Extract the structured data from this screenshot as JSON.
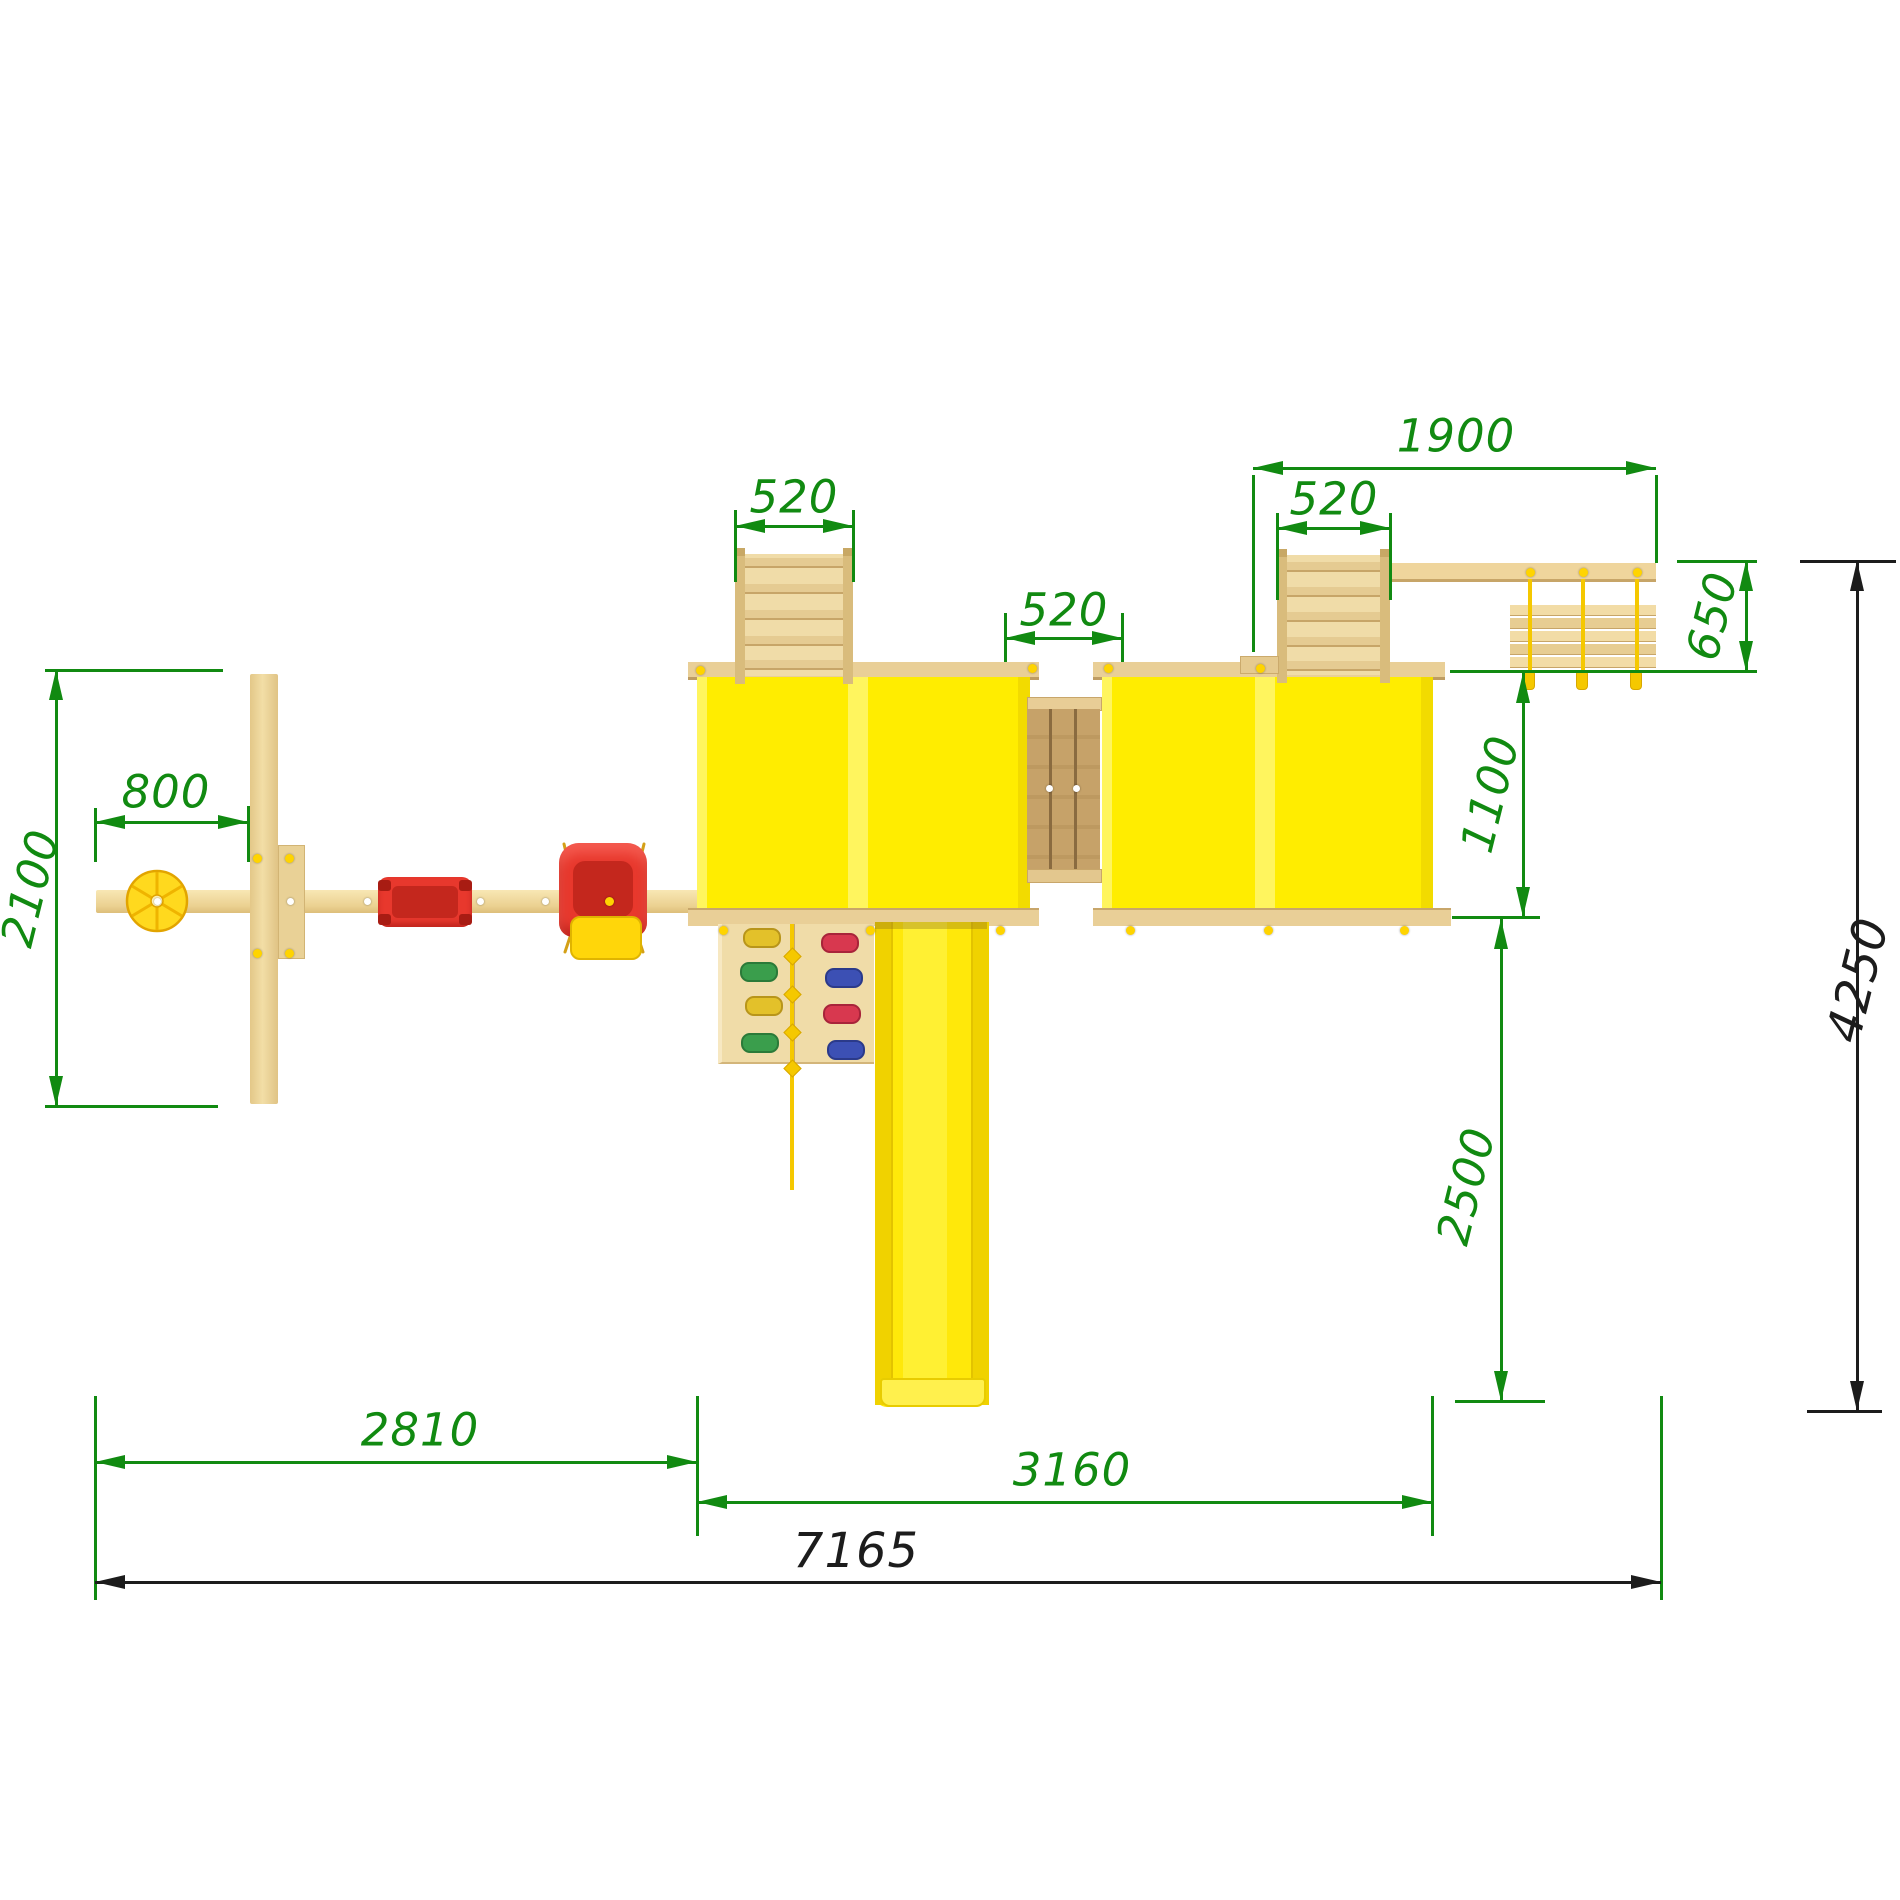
{
  "title": "Playground set – top view installation drawing",
  "units": "mm",
  "colors": {
    "dimension_green": "#118A11",
    "dimension_black": "#1c1c1c",
    "tower_yellow": "#FFED00",
    "slide_yellow": "#FFE80A",
    "wood_light": "#F2E0AB",
    "wood_floor": "#C4A067",
    "swing_red": "#E8382D",
    "rope_gold": "#F5C800"
  },
  "dimensions": [
    {
      "id": "dim-2100",
      "label": "2100",
      "c": "g",
      "fs": 45,
      "lx": 30,
      "ly": 888,
      "rot": -76,
      "lines": [
        [
          45,
          670,
          223,
          670
        ],
        [
          45,
          1106,
          218,
          1106
        ],
        [
          56,
          670,
          56,
          1106
        ]
      ],
      "arrows": [
        [
          56,
          670,
          "up"
        ],
        [
          56,
          1106,
          "down"
        ]
      ]
    },
    {
      "id": "dim-800",
      "label": "800",
      "c": "g",
      "fs": 45,
      "lx": 166,
      "ly": 792,
      "rot": 0,
      "lines": [
        [
          95,
          808,
          95,
          862
        ],
        [
          248,
          806,
          248,
          862
        ],
        [
          95,
          822,
          248,
          822
        ]
      ],
      "arrows": [
        [
          95,
          822,
          "left"
        ],
        [
          248,
          822,
          "right"
        ]
      ]
    },
    {
      "id": "dim-520-left",
      "label": "520",
      "c": "g",
      "fs": 45,
      "lx": 794,
      "ly": 497,
      "rot": 0,
      "lines": [
        [
          735,
          510,
          735,
          582
        ],
        [
          853,
          510,
          853,
          582
        ],
        [
          735,
          526,
          853,
          526
        ]
      ],
      "arrows": [
        [
          735,
          526,
          "left"
        ],
        [
          853,
          526,
          "right"
        ]
      ]
    },
    {
      "id": "dim-520-mid",
      "label": "520",
      "c": "g",
      "fs": 45,
      "lx": 1064,
      "ly": 610,
      "rot": 0,
      "lines": [
        [
          1005,
          613,
          1005,
          662
        ],
        [
          1122,
          613,
          1122,
          662
        ],
        [
          1005,
          638,
          1122,
          638
        ]
      ],
      "arrows": [
        [
          1005,
          638,
          "left"
        ],
        [
          1122,
          638,
          "right"
        ]
      ]
    },
    {
      "id": "dim-520-right",
      "label": "520",
      "c": "g",
      "fs": 45,
      "lx": 1334,
      "ly": 499,
      "rot": 0,
      "lines": [
        [
          1277,
          513,
          1277,
          600
        ],
        [
          1390,
          513,
          1390,
          600
        ],
        [
          1277,
          528,
          1390,
          528
        ]
      ],
      "arrows": [
        [
          1277,
          528,
          "left"
        ],
        [
          1390,
          528,
          "right"
        ]
      ]
    },
    {
      "id": "dim-1900",
      "label": "1900",
      "c": "g",
      "fs": 45,
      "lx": 1456,
      "ly": 436,
      "rot": 0,
      "lines": [
        [
          1253,
          475,
          1253,
          652
        ],
        [
          1656,
          475,
          1656,
          563
        ],
        [
          1253,
          468,
          1656,
          468
        ]
      ],
      "arrows": [
        [
          1253,
          468,
          "left"
        ],
        [
          1656,
          468,
          "right"
        ]
      ]
    },
    {
      "id": "dim-650",
      "label": "650",
      "c": "g",
      "fs": 45,
      "lx": 1712,
      "ly": 616,
      "rot": -76,
      "lines": [
        [
          1677,
          561,
          1757,
          561
        ],
        [
          1450,
          671,
          1757,
          671
        ],
        [
          1746,
          561,
          1746,
          671
        ]
      ],
      "arrows": [
        [
          1746,
          561,
          "up"
        ],
        [
          1746,
          671,
          "down"
        ]
      ]
    },
    {
      "id": "dim-1100",
      "label": "1100",
      "c": "g",
      "fs": 45,
      "lx": 1490,
      "ly": 794,
      "rot": -76,
      "lines": [
        [
          1523,
          671,
          1523,
          917
        ],
        [
          1452,
          917,
          1540,
          917
        ]
      ],
      "arrows": [
        [
          1523,
          673,
          "up"
        ],
        [
          1523,
          917,
          "down"
        ]
      ]
    },
    {
      "id": "dim-2500",
      "label": "2500",
      "c": "g",
      "fs": 45,
      "lx": 1466,
      "ly": 1186,
      "rot": -76,
      "lines": [
        [
          1501,
          917,
          1501,
          1401
        ],
        [
          1455,
          1401,
          1545,
          1401
        ]
      ],
      "arrows": [
        [
          1501,
          919,
          "up"
        ],
        [
          1501,
          1401,
          "down"
        ]
      ]
    },
    {
      "id": "dim-4250",
      "label": "4250",
      "c": "k",
      "fs": 48,
      "lx": 1858,
      "ly": 980,
      "rot": -76,
      "lines": [
        [
          1800,
          561,
          1896,
          561
        ],
        [
          1807,
          1411,
          1882,
          1411
        ],
        [
          1857,
          561,
          1857,
          1411
        ]
      ],
      "arrows": [
        [
          1857,
          561,
          "up"
        ],
        [
          1857,
          1411,
          "down"
        ]
      ]
    },
    {
      "id": "dim-2810",
      "label": "2810",
      "c": "g",
      "fs": 45,
      "lx": 420,
      "ly": 1430,
      "rot": 0,
      "lines": [
        [
          95,
          1396,
          95,
          1600
        ],
        [
          697,
          1396,
          697,
          1536
        ],
        [
          95,
          1462,
          697,
          1462
        ]
      ],
      "arrows": [
        [
          95,
          1462,
          "left"
        ],
        [
          697,
          1462,
          "right"
        ]
      ]
    },
    {
      "id": "dim-3160",
      "label": "3160",
      "c": "g",
      "fs": 45,
      "lx": 1072,
      "ly": 1470,
      "rot": 0,
      "lines": [
        [
          1432,
          1396,
          1432,
          1536
        ],
        [
          1661,
          1396,
          1661,
          1600
        ],
        [
          697,
          1502,
          1432,
          1502
        ]
      ],
      "arrows": [
        [
          697,
          1502,
          "left"
        ],
        [
          1432,
          1502,
          "right"
        ]
      ]
    },
    {
      "id": "dim-7165",
      "label": "7165",
      "c": "k",
      "fs": 48,
      "lx": 856,
      "ly": 1551,
      "rot": 0,
      "lines": [
        [
          95,
          1582,
          1661,
          1582
        ]
      ],
      "arrows": [
        [
          95,
          1582,
          "left"
        ],
        [
          1661,
          1582,
          "right"
        ]
      ]
    }
  ]
}
